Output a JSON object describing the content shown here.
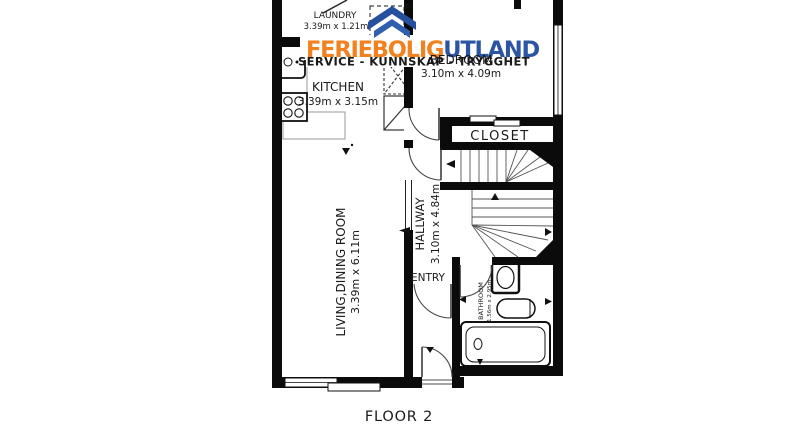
{
  "floor_label": "FLOOR 2",
  "watermark": {
    "brand_part1": "FERIEBOLIG",
    "brand_part2": "UTLAND",
    "tagline": "SERVICE - KUNNSKAP - TRYGGHET",
    "colors": {
      "orange": "#F2811F",
      "blue": "#2B55A3",
      "tagline_blue": "#3A6FB5",
      "roof_dark": "#24509E",
      "roof_light": "#2F5FAD"
    }
  },
  "rooms": {
    "laundry": {
      "name": "LAUNDRY",
      "dims": "3.39m x 1.21m"
    },
    "kitchen": {
      "name": "KITCHEN",
      "dims": "3.39m x 3.15m"
    },
    "bedroom": {
      "name": "BEDROOM",
      "dims": "3.10m x 4.09m"
    },
    "closet": {
      "name": "CLOSET"
    },
    "hallway": {
      "name": "HALLWAY",
      "dims": "3.10m x 4.84m"
    },
    "entry": {
      "name": "ENTRY"
    },
    "living_dining": {
      "name": "LIVING,DINING ROOM",
      "dims": "3.39m x 6.11m"
    },
    "bathroom": {
      "name": "BATHROOM",
      "dims": "1.56m x 2.95m"
    }
  }
}
